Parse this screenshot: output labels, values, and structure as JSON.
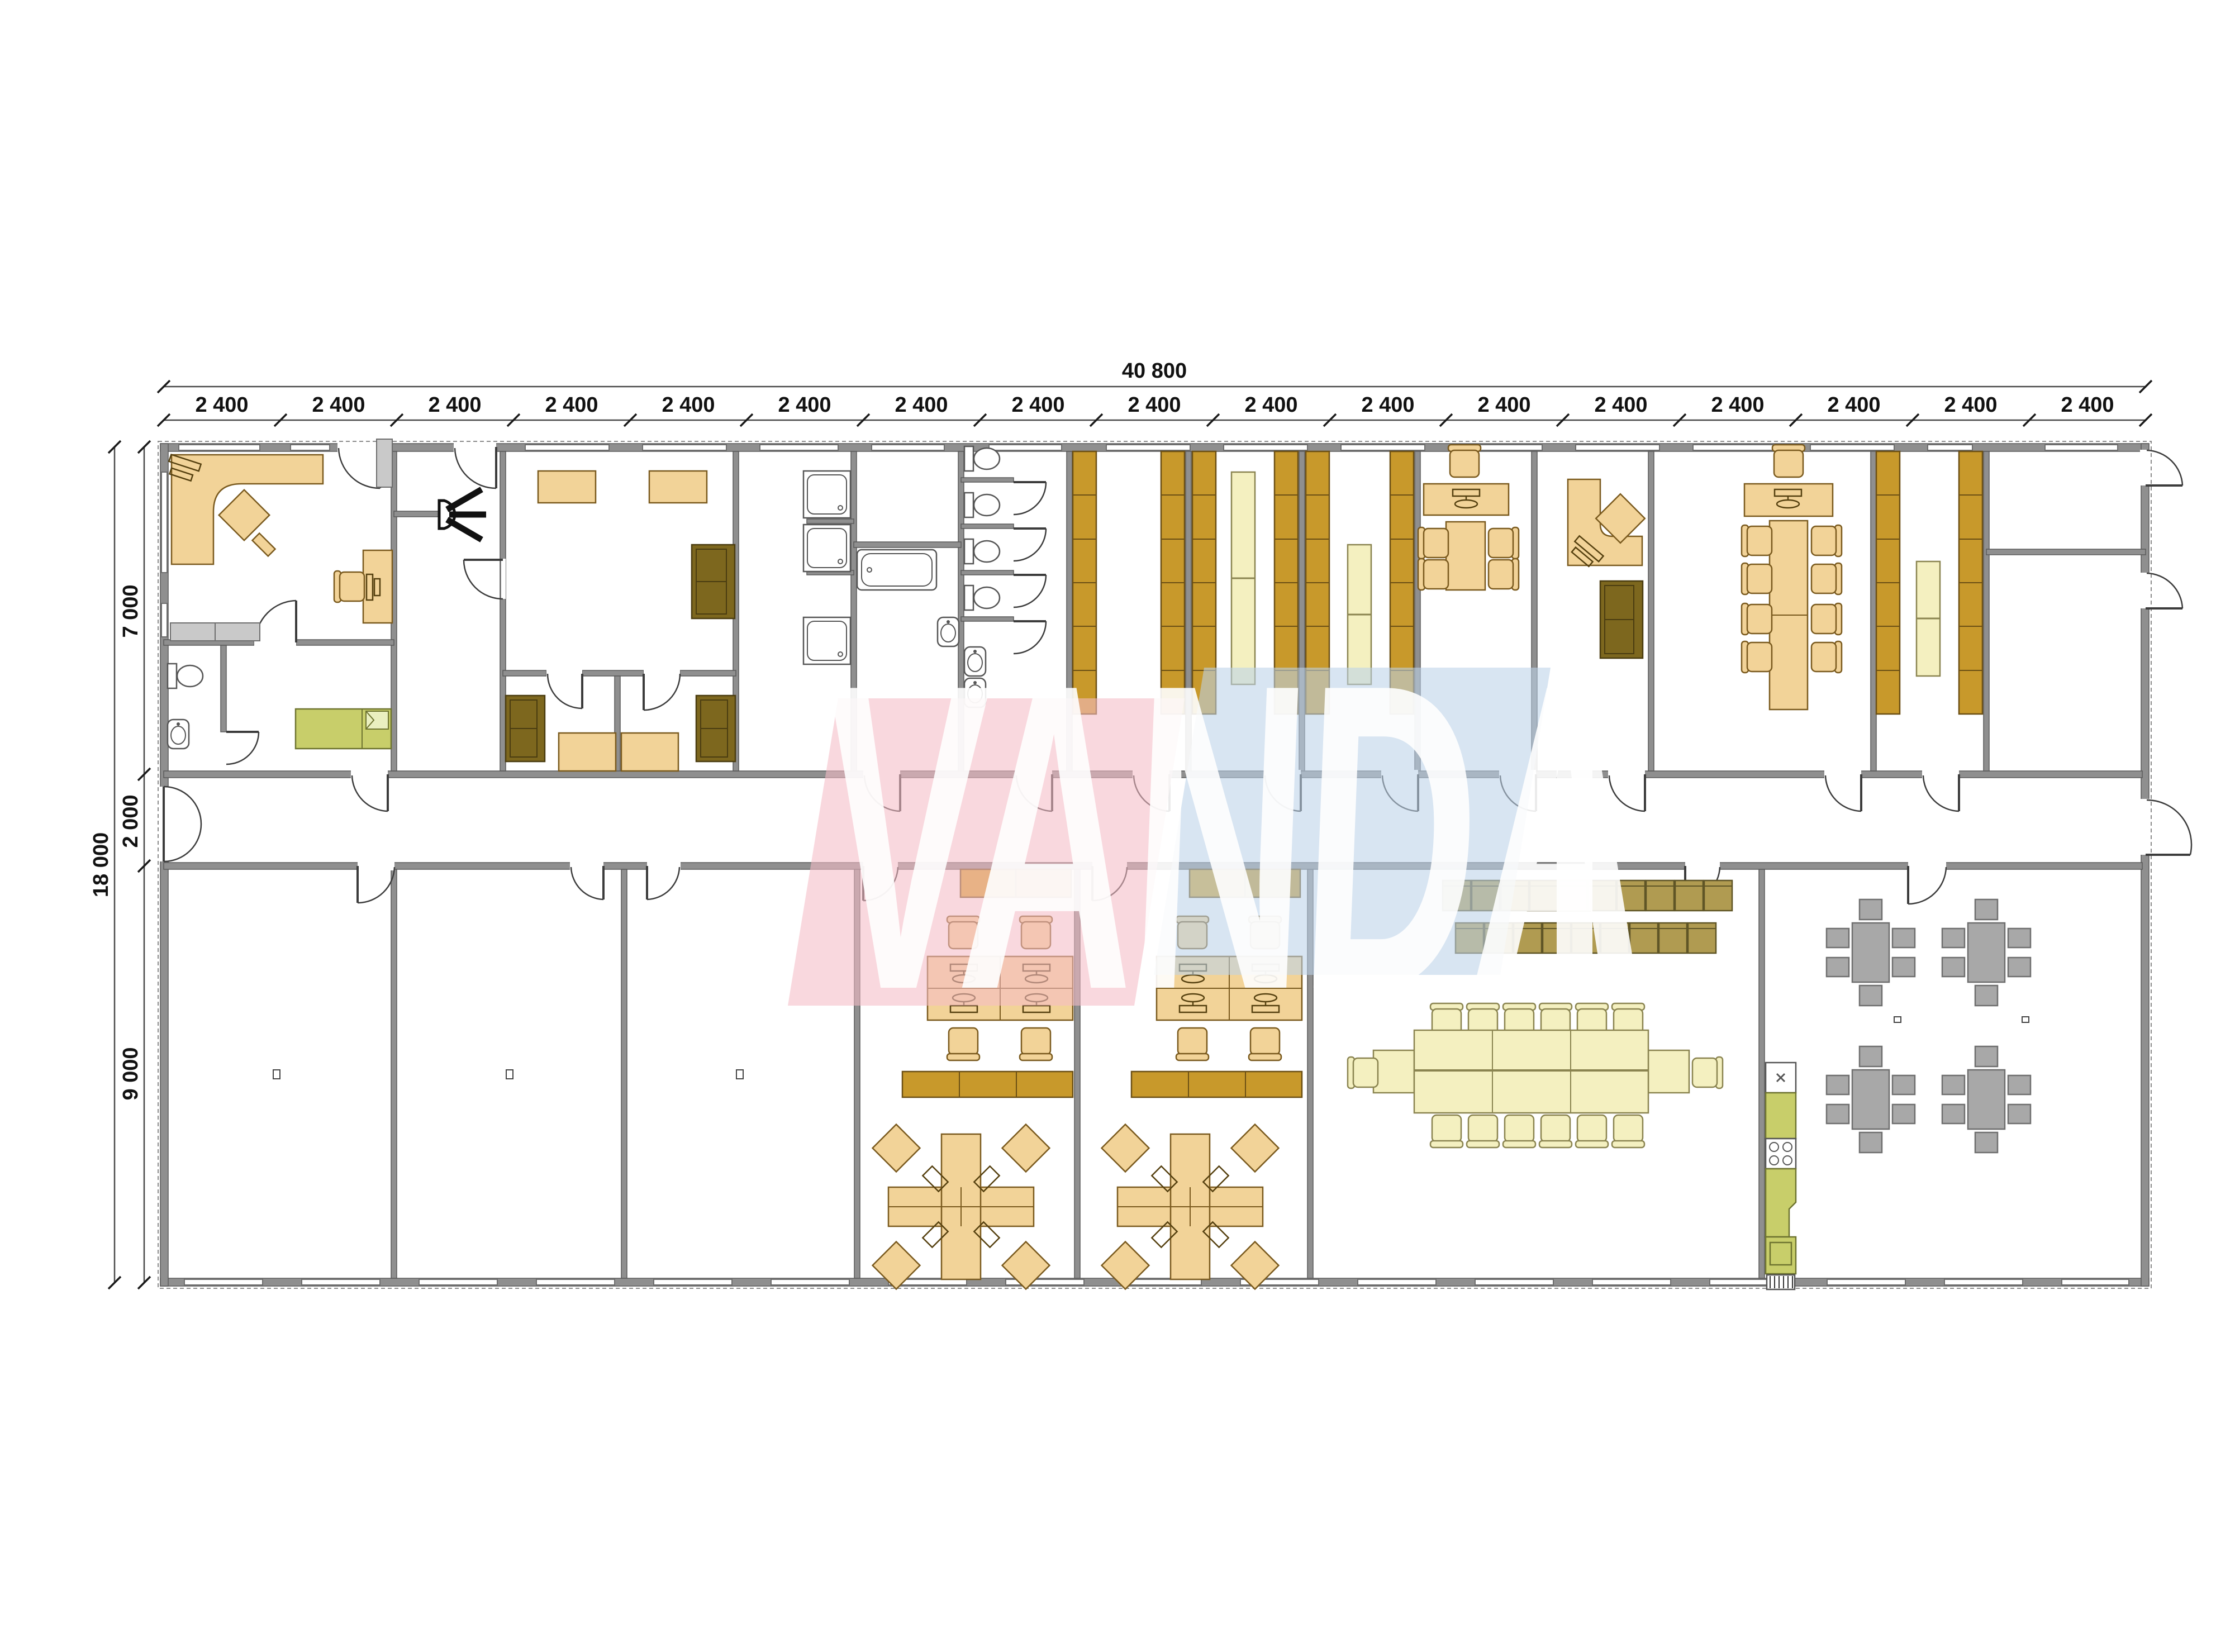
{
  "drawing": {
    "type": "architectural-floor-plan",
    "building": "modular office block, 17 bays",
    "watermark": {
      "text": "VANDA",
      "pink": "#F4BBC7",
      "blue": "#BCD3E9",
      "letter_color": "#FFFFFF"
    }
  },
  "dimensions": {
    "total_width_label": "40 800",
    "bay_count": 17,
    "top_segments": [
      "2 400",
      "2 400",
      "2 400",
      "2 400",
      "2 400",
      "2 400",
      "2 400",
      "2 400",
      "2 400",
      "2 400",
      "2 400",
      "2 400",
      "2 400",
      "2 400",
      "2 400",
      "2 400",
      "2 400"
    ],
    "left_total": "18 000",
    "left_bands": {
      "top": "7 000",
      "corridor": "2 000",
      "bottom": "9 000"
    }
  },
  "colors": {
    "wall": "#8F8F8F",
    "desk_tan": "#F2D398",
    "shelving_gold": "#C8992B",
    "cabinet_gold": "#D7A52F",
    "locker_khaki": "#B09B51",
    "sofa_dark": "#7D671E",
    "table_pale_yellow": "#F4F0C0",
    "bed_kitchen_green": "#C8CE6A",
    "cafeteria_gray": "#A8A8A8"
  },
  "icons": [
    "toilet-icon",
    "sink-icon",
    "bathtub-icon",
    "shower-icon",
    "bed-icon",
    "sofa-icon",
    "armchair-icon",
    "desk-icon",
    "office-chair-icon",
    "computer-icon",
    "shelving-icon",
    "locker-icon",
    "wardrobe-icon",
    "conference-table-icon",
    "dining-table-icon",
    "kitchen-sink-icon",
    "stove-icon",
    "fridge-icon",
    "wall-lamp-icon",
    "door-swing-icon",
    "window-icon",
    "dimension-tick-icon"
  ]
}
